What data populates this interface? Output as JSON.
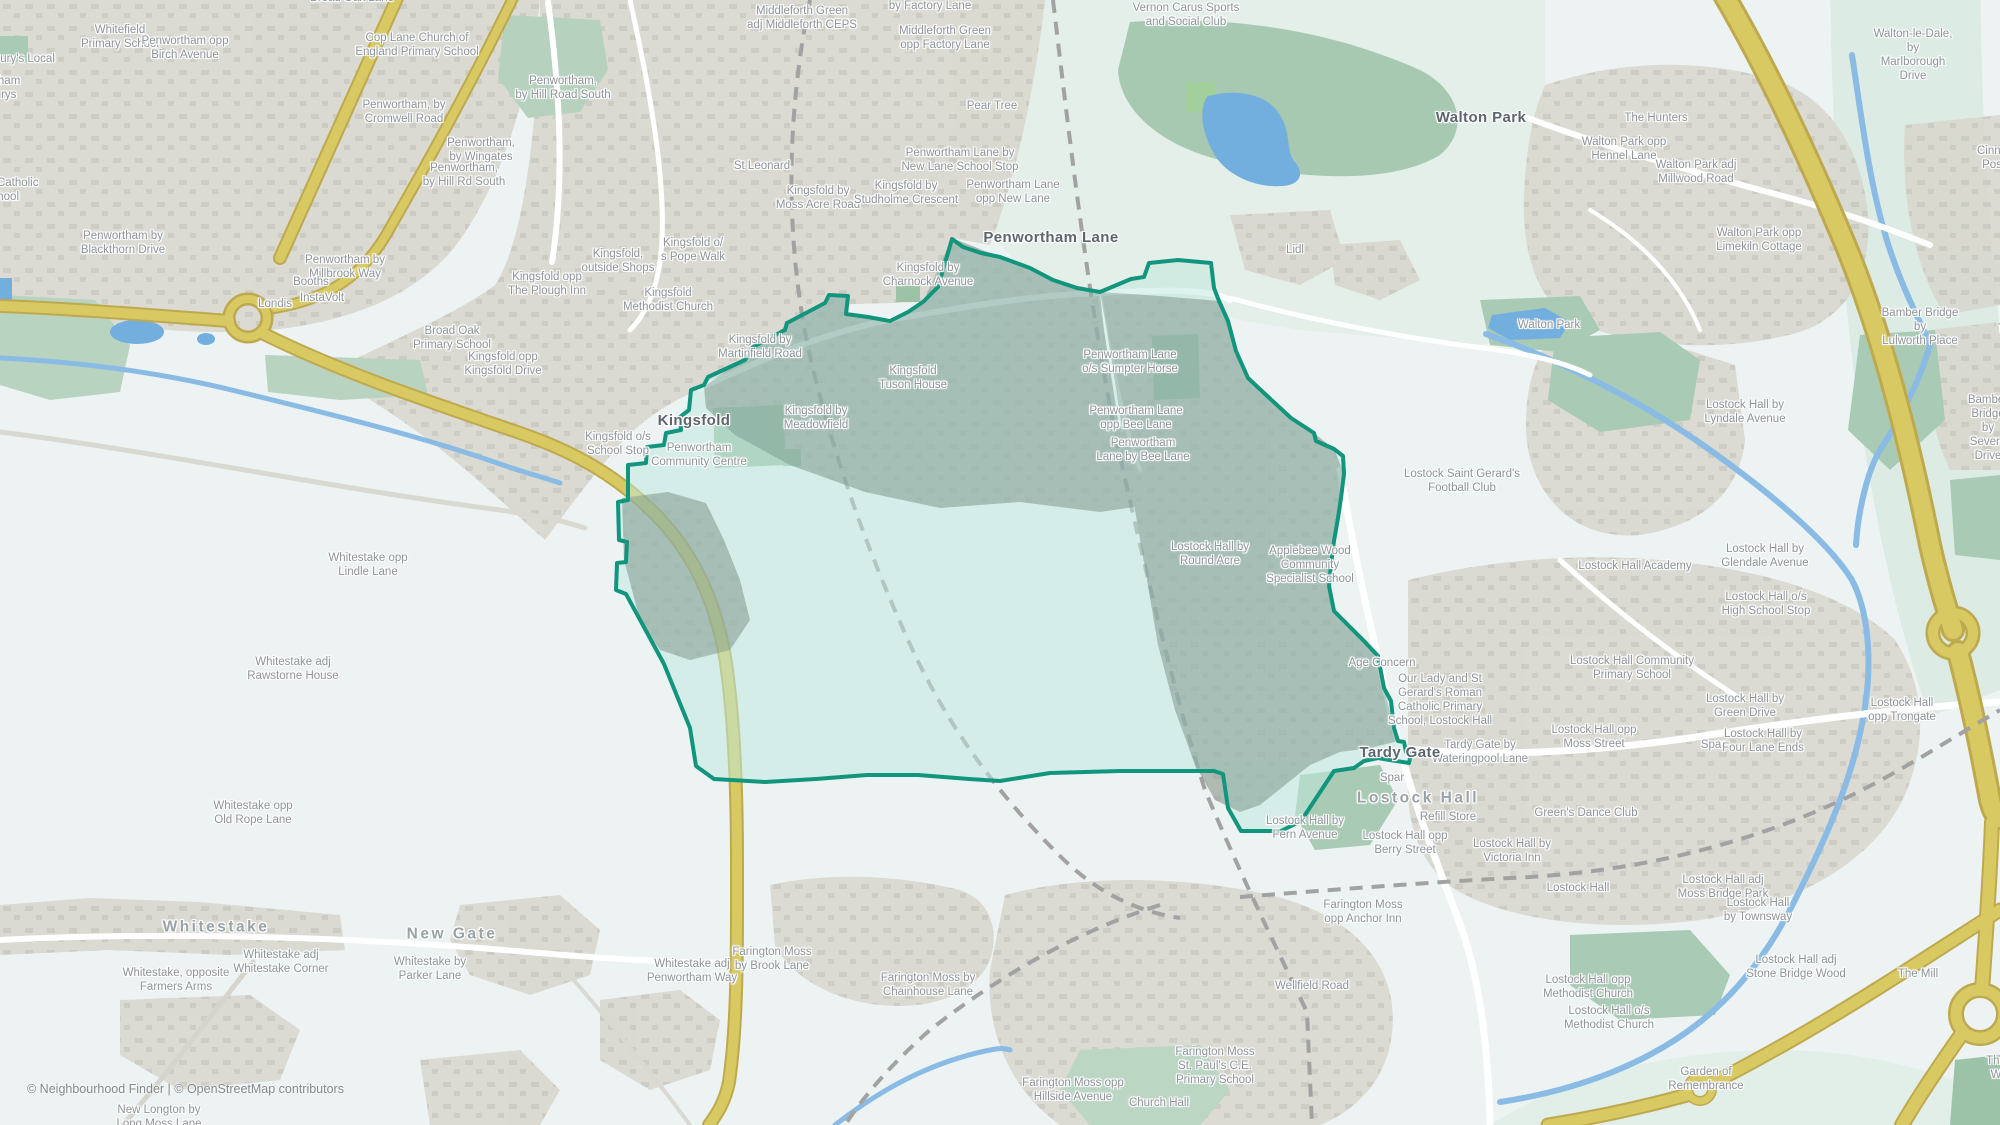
{
  "attribution": "© Neighbourhood Finder | © OpenStreetMap contributors",
  "colors": {
    "background": "#ecf3f2",
    "boundary": "#12957d",
    "boundary-fill": "#bfe8de",
    "water": "#72aede",
    "road-primary": "#d8c963",
    "road-casing": "#bfa94f",
    "residential": "#d8d6cd",
    "green": "#aecab7",
    "label": "#8e949a",
    "place-label": "#5c666d"
  },
  "map": {
    "labels": [
      {
        "t": "Whitefield\nPrimary School",
        "x": 120,
        "y": 37,
        "k": "s"
      },
      {
        "t": "Penwortham opp\nBirch Avenue",
        "x": 185,
        "y": 48,
        "k": "s"
      },
      {
        "t": "Sainsbury's Local",
        "x": 10,
        "y": 59,
        "k": "s"
      },
      {
        "t": "Penwortham\nSainsburys",
        "x": -12,
        "y": 88,
        "k": "s"
      },
      {
        "t": "Cop Lane Church of\nEngland Primary School",
        "x": 417,
        "y": 45,
        "k": "s"
      },
      {
        "t": "Penwortham, by\nCromwell Road",
        "x": 404,
        "y": 112,
        "k": "s"
      },
      {
        "t": "Penwortham,\nby Wingates",
        "x": 481,
        "y": 150,
        "k": "s"
      },
      {
        "t": "Penwortham,\nby Hill Rd South",
        "x": 464,
        "y": 175,
        "k": "s"
      },
      {
        "t": "All Hallows Catholic\nHigh School",
        "x": -12,
        "y": 190,
        "k": "s"
      },
      {
        "t": "Penwortham by\nBlackthorn Drive",
        "x": 123,
        "y": 243,
        "k": "s"
      },
      {
        "t": "Penwortham by\nMillbrook Way",
        "x": 345,
        "y": 267,
        "k": "s"
      },
      {
        "t": "Booths",
        "x": 311,
        "y": 282,
        "k": "s"
      },
      {
        "t": "InstaVolt",
        "x": 322,
        "y": 298,
        "k": "s"
      },
      {
        "t": "Londis",
        "x": 275,
        "y": 304,
        "k": "s"
      },
      {
        "t": "Broad Oak Lane",
        "x": 352,
        "y": -2,
        "k": "s"
      },
      {
        "t": "Broad Oak\nPrimary School",
        "x": 452,
        "y": 338,
        "k": "s"
      },
      {
        "t": "Kingsfold opp\nKingsfold Drive",
        "x": 503,
        "y": 364,
        "k": "s"
      },
      {
        "t": "Penwortham,\nby Hill Road South",
        "x": 563,
        "y": 88,
        "k": "s"
      },
      {
        "t": "Middleforth Green\nadj Middleforth CEPS",
        "x": 802,
        "y": 18,
        "k": "s"
      },
      {
        "t": "Middleforth Green\nby Factory Lane",
        "x": 930,
        "y": -1,
        "k": "s"
      },
      {
        "t": "Middleforth Green\nopp Factory Lane",
        "x": 945,
        "y": 38,
        "k": "s"
      },
      {
        "t": "Pear Tree",
        "x": 992,
        "y": 106,
        "k": "s"
      },
      {
        "t": "St Leonard",
        "x": 762,
        "y": 166,
        "k": "s"
      },
      {
        "t": "Kingsfold by\nMoss Acre Road",
        "x": 818,
        "y": 198,
        "k": "s"
      },
      {
        "t": "Kingsfold by\nStudholme Crescent",
        "x": 906,
        "y": 193,
        "k": "s"
      },
      {
        "t": "Penwortham Lane by\nNew Lane School Stop",
        "x": 960,
        "y": 160,
        "k": "s"
      },
      {
        "t": "Penwortham Lane\nopp New Lane",
        "x": 1013,
        "y": 192,
        "k": "s"
      },
      {
        "t": "Kingsfold,\noutside Shops",
        "x": 618,
        "y": 261,
        "k": "s"
      },
      {
        "t": "Kingsfold o/\ns Pope Walk",
        "x": 693,
        "y": 250,
        "k": "s"
      },
      {
        "t": "Kingsfold opp\nThe Plough Inn",
        "x": 547,
        "y": 284,
        "k": "s"
      },
      {
        "t": "Kingsfold\nMethodist Church",
        "x": 668,
        "y": 300,
        "k": "s"
      },
      {
        "t": "Kingsfold by\nCharnock Avenue",
        "x": 928,
        "y": 275,
        "k": "s"
      },
      {
        "t": "Kingsfold by\nMartinfield Road",
        "x": 760,
        "y": 347,
        "k": "s"
      },
      {
        "t": "Kingsfold\nTuson House",
        "x": 913,
        "y": 378,
        "k": "s"
      },
      {
        "t": "Kingsfold o/s\nSchool Stop",
        "x": 618,
        "y": 444,
        "k": "s"
      },
      {
        "t": "Penwortham\nCommunity Centre",
        "x": 699,
        "y": 455,
        "k": "s"
      },
      {
        "t": "Kingsfold by\nMeadowfield",
        "x": 816,
        "y": 418,
        "k": "s"
      },
      {
        "t": "Vernon Carus Sports\nand Social Club",
        "x": 1186,
        "y": 15,
        "k": "s"
      },
      {
        "t": "Lidl",
        "x": 1295,
        "y": 250,
        "k": "s"
      },
      {
        "t": "Walton Park",
        "x": 1549,
        "y": 325,
        "k": "s"
      },
      {
        "t": "Penwortham Lane\no/s Sumpter Horse",
        "x": 1130,
        "y": 362,
        "k": "s"
      },
      {
        "t": "Penwortham Lane\nopp Bee Lane",
        "x": 1136,
        "y": 418,
        "k": "s"
      },
      {
        "t": "Penwortham\nLane by Bee Lane",
        "x": 1143,
        "y": 450,
        "k": "s"
      },
      {
        "t": "Lostock Hall by\nRound Acre",
        "x": 1210,
        "y": 554,
        "k": "s"
      },
      {
        "t": "Applebee Wood\nCommunity\nSpecialist School",
        "x": 1310,
        "y": 565,
        "k": "s"
      },
      {
        "t": "Lostock Saint Gerard's\nFootball Club",
        "x": 1462,
        "y": 481,
        "k": "s"
      },
      {
        "t": "Age Concern",
        "x": 1382,
        "y": 663,
        "k": "s"
      },
      {
        "t": "Our Lady and St\nGerard's Roman\nCatholic Primary\nSchool, Lostock Hall",
        "x": 1440,
        "y": 700,
        "k": "s"
      },
      {
        "t": "Tardy Gate by\nWateringpool Lane",
        "x": 1480,
        "y": 752,
        "k": "s"
      },
      {
        "t": "Spar",
        "x": 1392,
        "y": 778,
        "k": "s"
      },
      {
        "t": "Refill Store",
        "x": 1448,
        "y": 817,
        "k": "s"
      },
      {
        "t": "Lostock Hall by\nFern Avenue",
        "x": 1305,
        "y": 828,
        "k": "s"
      },
      {
        "t": "Lostock Hall opp\nBerry Street",
        "x": 1405,
        "y": 843,
        "k": "s"
      },
      {
        "t": "Lostock Hall by\nVictoria Inn",
        "x": 1512,
        "y": 851,
        "k": "s"
      },
      {
        "t": "Lostock Hall",
        "x": 1578,
        "y": 888,
        "k": "s"
      },
      {
        "t": "Lostock Hall adj\nMoss Bridge Park",
        "x": 1723,
        "y": 887,
        "k": "s"
      },
      {
        "t": "Lostock Hall by\nLyndale Avenue",
        "x": 1745,
        "y": 412,
        "k": "s"
      },
      {
        "t": "Bamber Bridge by\nLulworth Place",
        "x": 1920,
        "y": 327,
        "k": "s"
      },
      {
        "t": "Bamber Bridge\nTennyson Avenue",
        "x": 2022,
        "y": 322,
        "k": "s"
      },
      {
        "t": "Bamber Bridge\nby Severn Drive",
        "x": 1988,
        "y": 428,
        "k": "s"
      },
      {
        "t": "Walton-le-Dale, by\nMarlborough Drive",
        "x": 1913,
        "y": 55,
        "k": "s"
      },
      {
        "t": "The Hunters",
        "x": 1656,
        "y": 118,
        "k": "s"
      },
      {
        "t": "Walton Park opp\nHennel Lane",
        "x": 1624,
        "y": 149,
        "k": "s"
      },
      {
        "t": "Walton Park adj\nMillwood Road",
        "x": 1696,
        "y": 172,
        "k": "s"
      },
      {
        "t": "Walton Park opp\nLimekiln Cottage",
        "x": 1759,
        "y": 240,
        "k": "s"
      },
      {
        "t": "Cinna\nPos",
        "x": 1992,
        "y": 158,
        "k": "s"
      },
      {
        "t": "Lostock Hall Academy",
        "x": 1635,
        "y": 566,
        "k": "s"
      },
      {
        "t": "Lostock Hall by\nGlendale Avenue",
        "x": 1765,
        "y": 556,
        "k": "s"
      },
      {
        "t": "Lostock Hall o/s\nHigh School Stop",
        "x": 1766,
        "y": 604,
        "k": "s"
      },
      {
        "t": "Lostock Hall Community\nPrimary School",
        "x": 1632,
        "y": 668,
        "k": "s"
      },
      {
        "t": "Lostock Hall by\nGreen Drive",
        "x": 1745,
        "y": 706,
        "k": "s"
      },
      {
        "t": "Lostock Hall\nopp Trongate",
        "x": 1902,
        "y": 710,
        "k": "s"
      },
      {
        "t": "Lostock Hall opp\nMoss Street",
        "x": 1594,
        "y": 737,
        "k": "s"
      },
      {
        "t": "Spar",
        "x": 1713,
        "y": 745,
        "k": "s"
      },
      {
        "t": "Lostock Hall by\nFour Lane Ends",
        "x": 1763,
        "y": 741,
        "k": "s"
      },
      {
        "t": "Green's Dance Club",
        "x": 1586,
        "y": 813,
        "k": "s"
      },
      {
        "t": "Lostock Hall\nby Townsway",
        "x": 1758,
        "y": 910,
        "k": "s"
      },
      {
        "t": "Lostock Hall adj\nStone Bridge Wood",
        "x": 1796,
        "y": 967,
        "k": "s"
      },
      {
        "t": "The Mill",
        "x": 1918,
        "y": 974,
        "k": "s"
      },
      {
        "t": "Lostock Hall opp\nMethodist Church",
        "x": 1588,
        "y": 987,
        "k": "s"
      },
      {
        "t": "Lostock Hall o/s\nMethodist Church",
        "x": 1609,
        "y": 1018,
        "k": "s"
      },
      {
        "t": "Garden of\nRemembrance",
        "x": 1706,
        "y": 1079,
        "k": "s"
      },
      {
        "t": "The W",
        "x": 1996,
        "y": 1068,
        "k": "s"
      },
      {
        "t": "Farington Moss\nopp Anchor Inn",
        "x": 1363,
        "y": 912,
        "k": "s"
      },
      {
        "t": "Wellfield Road",
        "x": 1312,
        "y": 986,
        "k": "s"
      },
      {
        "t": "Farington Moss\nSt. Paul's C.E.\nPrimary School",
        "x": 1215,
        "y": 1066,
        "k": "s"
      },
      {
        "t": "Farington Moss opp\nHillside Avenue",
        "x": 1073,
        "y": 1090,
        "k": "s"
      },
      {
        "t": "Church Hall",
        "x": 1159,
        "y": 1103,
        "k": "s"
      },
      {
        "t": "Whitestake opp\nLindle Lane",
        "x": 368,
        "y": 565,
        "k": "s"
      },
      {
        "t": "Whitestake adj\nRawstorne House",
        "x": 293,
        "y": 669,
        "k": "s"
      },
      {
        "t": "Whitestake opp\nOld Rope Lane",
        "x": 253,
        "y": 813,
        "k": "s"
      },
      {
        "t": "Whitestake, opposite\nFarmers Arms",
        "x": 176,
        "y": 980,
        "k": "s"
      },
      {
        "t": "Whitestake adj\nWhitestake Corner",
        "x": 281,
        "y": 962,
        "k": "s"
      },
      {
        "t": "Whitestake by\nParker Lane",
        "x": 430,
        "y": 969,
        "k": "s"
      },
      {
        "t": "New Longton by\nLong Moss Lane",
        "x": 159,
        "y": 1117,
        "k": "s"
      },
      {
        "t": "Whitestake adj\nPenwortham Way",
        "x": 692,
        "y": 971,
        "k": "s"
      },
      {
        "t": "Farington Moss\nby Brook Lane",
        "x": 772,
        "y": 959,
        "k": "s"
      },
      {
        "t": "Farington Moss by\nChainhouse Lane",
        "x": 928,
        "y": 985,
        "k": "s"
      },
      {
        "t": "Penwortham Lane",
        "x": 1051,
        "y": 238,
        "k": "p"
      },
      {
        "t": "Kingsfold",
        "x": 694,
        "y": 421,
        "k": "p"
      },
      {
        "t": "Walton Park",
        "x": 1481,
        "y": 118,
        "k": "p"
      },
      {
        "t": "Tardy Gate",
        "x": 1400,
        "y": 753,
        "k": "p"
      },
      {
        "t": "Whitestake",
        "x": 216,
        "y": 928,
        "k": "a"
      },
      {
        "t": "New Gate",
        "x": 452,
        "y": 935,
        "k": "a"
      },
      {
        "t": "Lostock Hall",
        "x": 1418,
        "y": 799,
        "k": "a"
      }
    ]
  }
}
